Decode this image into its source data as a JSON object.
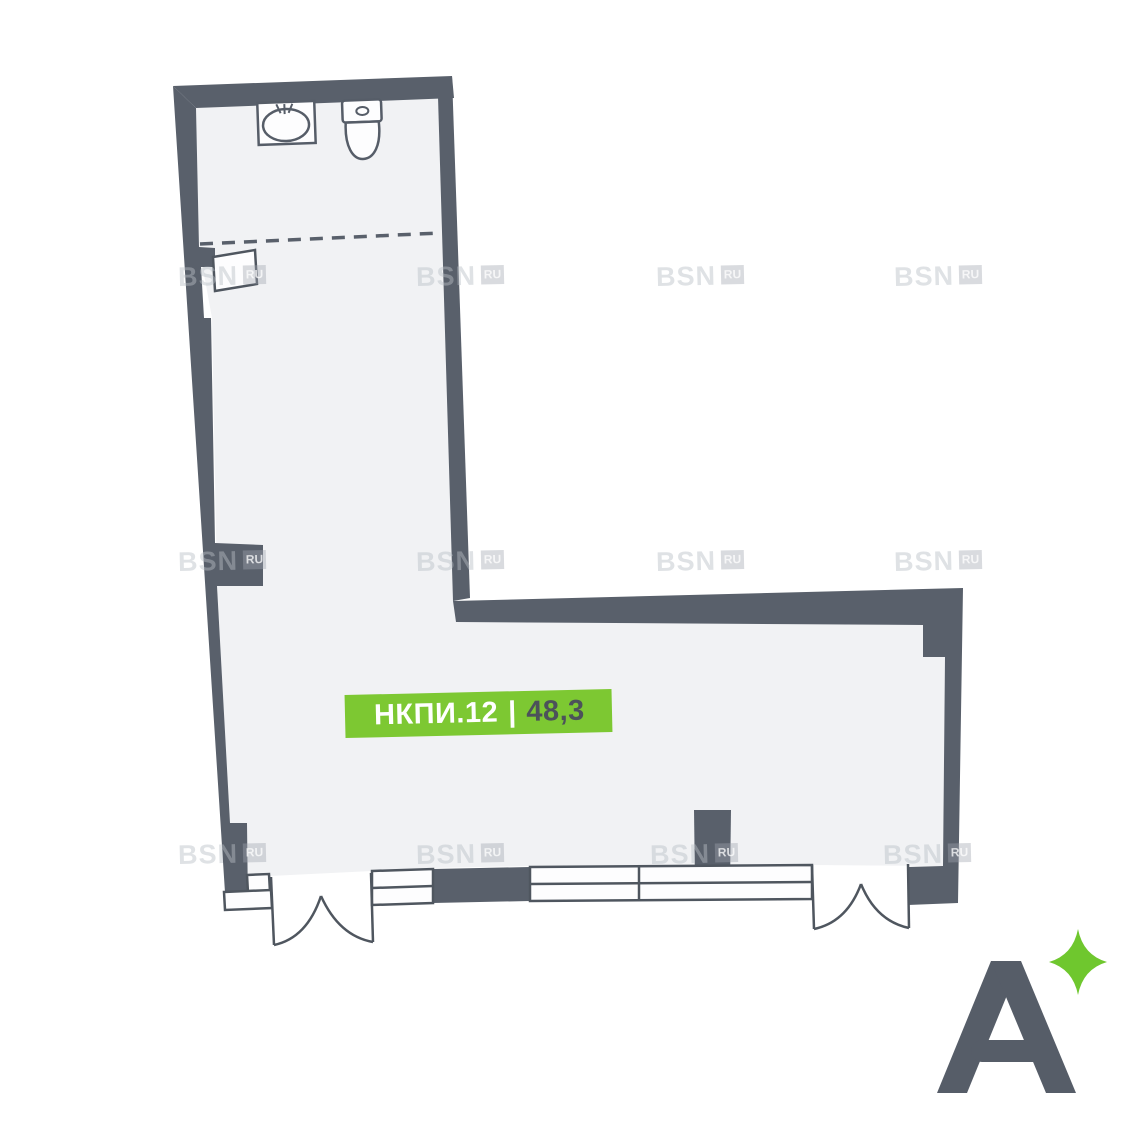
{
  "unit_label": {
    "code": "НКПИ.12",
    "separator": "|",
    "area": "48,3"
  },
  "watermark": {
    "text": "BSN",
    "suffix": "RU"
  },
  "logo": {
    "glyph": "A",
    "sparkle": "sparkle-icon"
  },
  "icons": {
    "sink": "sink-icon",
    "toilet": "toilet-icon"
  },
  "colors": {
    "wall": "#59606B",
    "floor": "#F1F2F4",
    "outline": "#4F565F",
    "accent_green": "#7DC832",
    "sparkle_green": "#6FC72E",
    "logo_gray": "#565D68",
    "label_text_light": "#FFFFFF",
    "label_text_dark": "#4C525A",
    "background": "#FFFFFF"
  }
}
